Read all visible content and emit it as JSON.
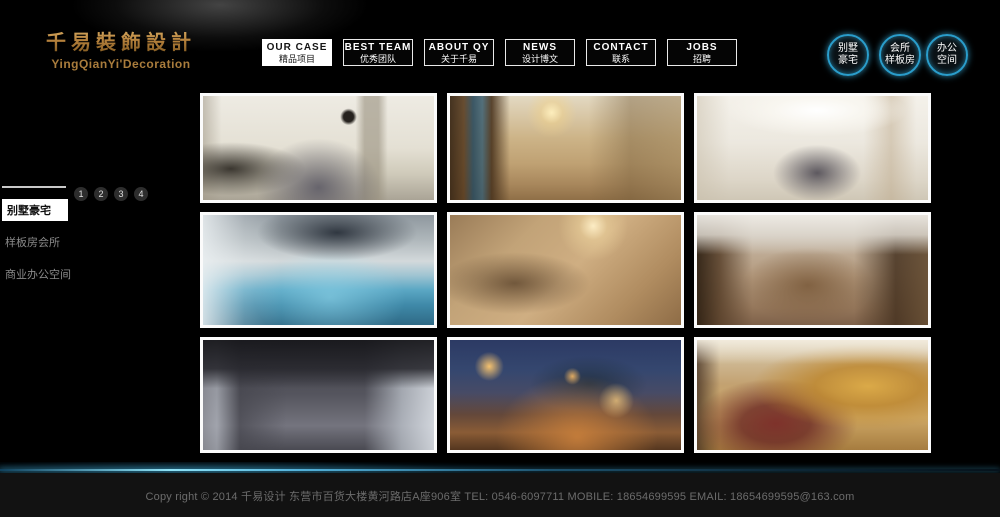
{
  "brand": {
    "logo_cn": "千易裝飾設計",
    "logo_en": "YingQianYi'Decoration"
  },
  "nav": {
    "items": [
      {
        "en": "OUR CASE",
        "cn": "精品项目",
        "active": true
      },
      {
        "en": "BEST TEAM",
        "cn": "优秀团队",
        "active": false
      },
      {
        "en": "ABOUT QY",
        "cn": "关于千易",
        "active": false
      },
      {
        "en": "NEWS",
        "cn": "设计博文",
        "active": false
      },
      {
        "en": "CONTACT",
        "cn": "联系",
        "active": false
      },
      {
        "en": "JOBS",
        "cn": "招聘",
        "active": false
      }
    ]
  },
  "quick_links": [
    {
      "line1": "别墅",
      "line2": "豪宅"
    },
    {
      "line1": "会所",
      "line2": "样板房"
    },
    {
      "line1": "办公",
      "line2": "空间"
    }
  ],
  "sidebar": {
    "pagination": [
      "1",
      "2",
      "3",
      "4"
    ],
    "items": [
      {
        "label": "别墅豪宅",
        "active": true
      },
      {
        "label": "样板房会所",
        "active": false
      },
      {
        "label": "商业办公空间",
        "active": false
      }
    ]
  },
  "gallery": {
    "items": [
      {
        "name": "modern-living-room",
        "bg": "radial-gradient(circle at 63% 20%, #26221e 0%, #26221e 3%, rgba(38,34,30,0) 5%), radial-gradient(ellipse at 50% 88%, rgba(88,86,98,0.85) 0%, rgba(88,86,98,0) 38%), radial-gradient(ellipse at 12% 70%, rgba(42,38,32,0.9) 0%, rgba(42,38,32,0) 26%), linear-gradient(90deg, rgba(160,152,136,0.55) 0%, rgba(160,152,136,0) 8%, rgba(160,152,136,0) 66%, rgba(150,142,124,0.6) 70%, rgba(150,142,124,0.6) 76%, rgba(160,152,136,0) 80%), linear-gradient(180deg, #eeebe3 0%, #e4e0d4 50%, #cfcaba 75%, #aaa496 100%)"
      },
      {
        "name": "luxury-double-height-living-room",
        "bg": "radial-gradient(circle at 44% 16%, rgba(255,240,190,0.95) 0%, rgba(240,210,140,0.5) 7%, rgba(240,210,140,0) 16%), linear-gradient(90deg, rgba(60,42,24,0.95) 0%, rgba(90,62,34,0.9) 6%, rgba(42,74,92,0.9) 10%, rgba(58,94,112,0.85) 14%, rgba(74,52,30,0.9) 18%, rgba(74,52,30,0) 26%, rgba(0,0,0,0) 60%, rgba(120,95,60,0.45) 78%, rgba(150,125,85,0.5) 100%), linear-gradient(180deg, #e3d9c2 0%, #cdb488 40%, #bfa173 65%, #a8875c 85%, #8f6f47 100%)"
      },
      {
        "name": "white-dining-room",
        "bg": "radial-gradient(ellipse 90px 26px at 52% 14%, #ffffff 0%, rgba(250,248,242,0.8) 50%, rgba(250,248,242,0) 100%), radial-gradient(ellipse at 52% 74%, rgba(70,66,76,0.85) 0%, rgba(70,66,76,0) 26%), linear-gradient(90deg, rgba(200,190,170,0.5) 0%, rgba(0,0,0,0) 14%, rgba(0,0,0,0) 72%, rgba(190,170,140,0.5) 84%, rgba(0,0,0,0) 95%), linear-gradient(180deg, #f4f1ea 0%, #ece8df 45%, #ddd6c8 80%, #cfc7b6 100%)"
      },
      {
        "name": "indoor-pool",
        "bg": "radial-gradient(ellipse 80px 28px at 58% 16%, rgba(35,42,52,0.9) 0%, rgba(35,42,52,0) 100%), linear-gradient(90deg, rgba(235,240,242,0.85) 0%, rgba(235,240,242,0.25) 18%, rgba(0,0,0,0) 34%), radial-gradient(ellipse at 55% 75%, rgba(150,220,240,0.55) 0%, rgba(150,220,240,0) 42%), linear-gradient(180deg, #8e979e 0%, #aeb6ba 22%, #d3d9db 42%, #9fc4d2 55%, #5ba7c4 68%, #3f89a8 82%, #2f6a86 100%)"
      },
      {
        "name": "grand-staircase-hall",
        "bg": "radial-gradient(circle at 62% 10%, rgba(255,240,200,0.95) 0%, rgba(240,215,160,0.5) 8%, rgba(240,215,160,0) 20%), radial-gradient(ellipse at 28% 62%, rgba(92,68,44,0.8) 0%, rgba(92,68,44,0) 32%), linear-gradient(135deg, #9a7c58 0%, #c2a378 28%, #cfae82 52%, #b08c60 78%, #8e6c46 100%)"
      },
      {
        "name": "chinese-style-living-room",
        "bg": "linear-gradient(180deg, rgba(238,235,229,0.95) 0%, rgba(222,217,208,0.85) 18%, rgba(222,217,208,0) 36%), linear-gradient(90deg, rgba(48,34,20,0.95) 0%, rgba(88,64,42,0.85) 10%, rgba(88,64,42,0) 24%, rgba(0,0,0,0) 68%, rgba(70,50,32,0.85) 86%, rgba(100,76,50,0.9) 100%), radial-gradient(ellipse at 48% 64%, rgba(122,90,58,0.85) 0%, rgba(122,90,58,0) 38%), linear-gradient(180deg, #cfc8bc 0%, #b49a7e 55%, #94765a 85%, #7e614a 100%)"
      },
      {
        "name": "modern-dark-penthouse",
        "bg": "linear-gradient(180deg, rgba(24,24,28,0.95) 0%, rgba(40,40,46,0.9) 26%, rgba(40,40,46,0) 44%), linear-gradient(90deg, rgba(150,152,160,0.8) 0%, rgba(180,184,192,0.7) 6%, rgba(70,70,78,0.7) 16%, rgba(0,0,0,0) 36%, rgba(0,0,0,0) 70%, rgba(190,196,204,0.75) 86%, rgba(225,230,236,0.85) 100%), linear-gradient(180deg, #3c3c44 0%, #55555e 50%, #74747e 78%, #4a4a52 100%)"
      },
      {
        "name": "night-courtyard-terrace",
        "bg": "radial-gradient(circle at 17% 24%, rgba(255,200,110,0.95) 0%, rgba(255,200,110,0) 7%), radial-gradient(circle at 53% 33%, rgba(255,190,100,0.85) 0%, rgba(255,190,100,0) 6%), radial-gradient(circle at 72% 55%, rgba(255,210,130,0.7) 0%, rgba(255,210,130,0) 10%), radial-gradient(ellipse at 55% 88%, rgba(205,130,60,0.85) 0%, rgba(205,130,60,0) 45%), radial-gradient(ellipse at 60% 40%, rgba(30,45,60,0.8) 0%, rgba(30,45,60,0) 30%), linear-gradient(180deg, #2c3a64 0%, #35476f 28%, #474b66 48%, #64483a 68%, #8a5c36 84%, #54361f 100%)"
      },
      {
        "name": "golden-ornate-villa-hall",
        "bg": "linear-gradient(180deg, rgba(244,238,224,0.9) 0%, rgba(244,238,224,0) 22%), radial-gradient(ellipse at 74% 42%, rgba(220,170,70,0.95) 0%, rgba(190,135,45,0.8) 22%, rgba(190,135,45,0) 48%), radial-gradient(ellipse at 34% 76%, rgba(122,44,40,0.95) 0%, rgba(106,40,36,0.8) 16%, rgba(106,40,36,0) 38%), linear-gradient(90deg, rgba(70,50,35,0.8) 0%, rgba(0,0,0,0) 10%), linear-gradient(180deg, #d9cdb4 0%, #c3a271 40%, #cfa967 70%, #a67c3f 100%)"
      }
    ]
  },
  "footer": {
    "copyright": "Copy right © 2014 千易设计 东营市百货大楼黄河路店A座906室 TEL: 0546-6097711 MOBILE: 18654699595 EMAIL: 18654699595@163.com"
  },
  "colors": {
    "accent_gold": "#b5813c",
    "accent_cyan": "#2a9dcb",
    "background": "#000000",
    "footer_bg": "#121212"
  }
}
